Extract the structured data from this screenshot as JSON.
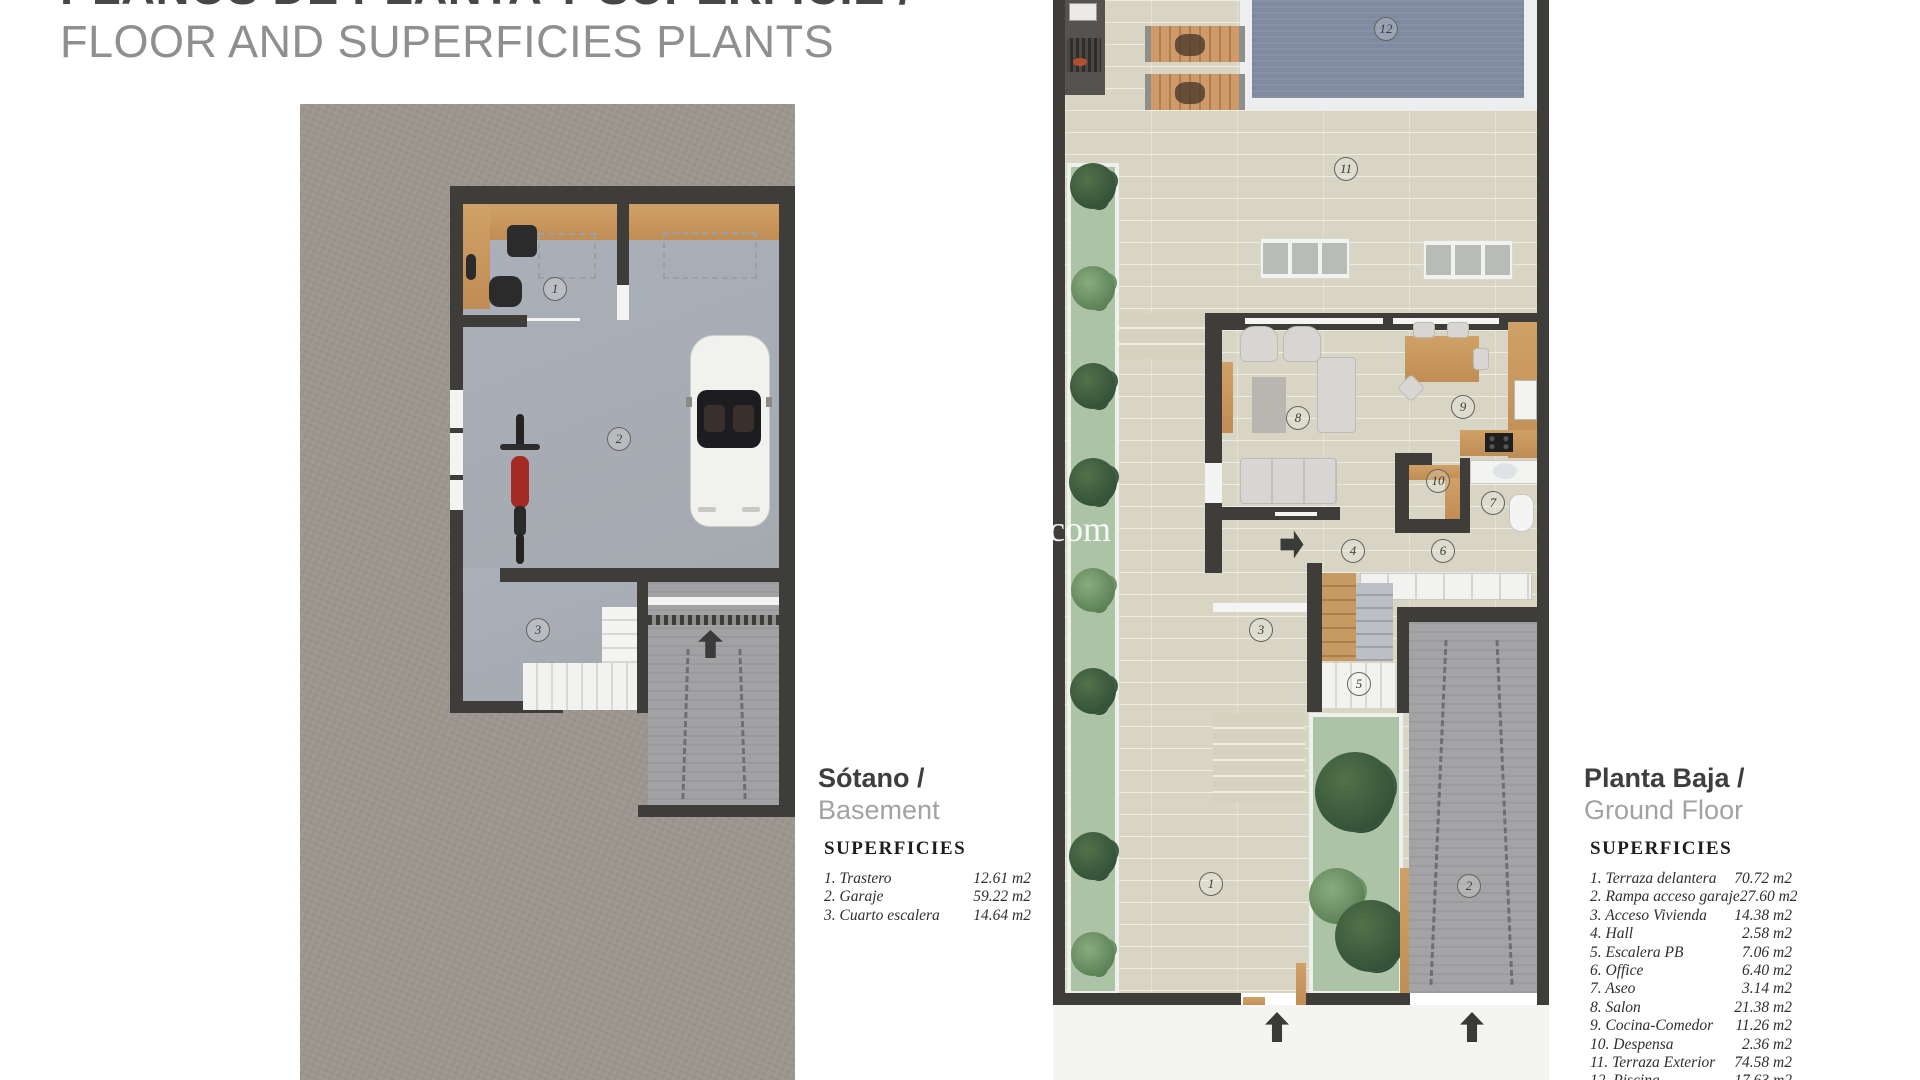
{
  "header": {
    "title_es": "PLANOS DE PLANTA Y SUPERFICIE /",
    "title_en": "FLOOR AND SUPERFICIES PLANTS"
  },
  "watermark": "com",
  "plans": {
    "basement": {
      "title_es": "Sótano /",
      "title_en": "Basement",
      "legend_title": "SUPERFICIES",
      "rooms": [
        {
          "num": "1",
          "label": "1. Trastero",
          "area": "12.61  m2"
        },
        {
          "num": "2",
          "label": "2. Garaje",
          "area": "59.22 m2"
        },
        {
          "num": "3",
          "label": "3. Cuarto escalera",
          "area": "14.64 m2"
        }
      ]
    },
    "ground": {
      "title_es": "Planta Baja /",
      "title_en": "Ground Floor",
      "legend_title": "SUPERFICIES",
      "rooms": [
        {
          "num": "1",
          "label": "1. Terraza delantera",
          "area": "70.72 m2"
        },
        {
          "num": "2",
          "label": "2. Rampa acceso garaje",
          "area": "27.60 m2"
        },
        {
          "num": "3",
          "label": "3. Acceso Vivienda",
          "area": "14.38 m2"
        },
        {
          "num": "4",
          "label": "4. Hall",
          "area": "2.58 m2"
        },
        {
          "num": "5",
          "label": "5. Escalera PB",
          "area": "7.06 m2"
        },
        {
          "num": "6",
          "label": "6. Office",
          "area": "6.40 m2"
        },
        {
          "num": "7",
          "label": "7. Aseo",
          "area": "3.14 m2"
        },
        {
          "num": "8",
          "label": "8. Salon",
          "area": "21.38 m2"
        },
        {
          "num": "9",
          "label": "9. Cocina-Comedor",
          "area": "11.26 m2"
        },
        {
          "num": "10",
          "label": "10. Despensa",
          "area": "2.36 m2"
        },
        {
          "num": "11",
          "label": "11. Terraza Exterior",
          "area": "74.58 m2"
        },
        {
          "num": "12",
          "label": "12. Piscina",
          "area": "17.63 m2"
        }
      ]
    }
  }
}
